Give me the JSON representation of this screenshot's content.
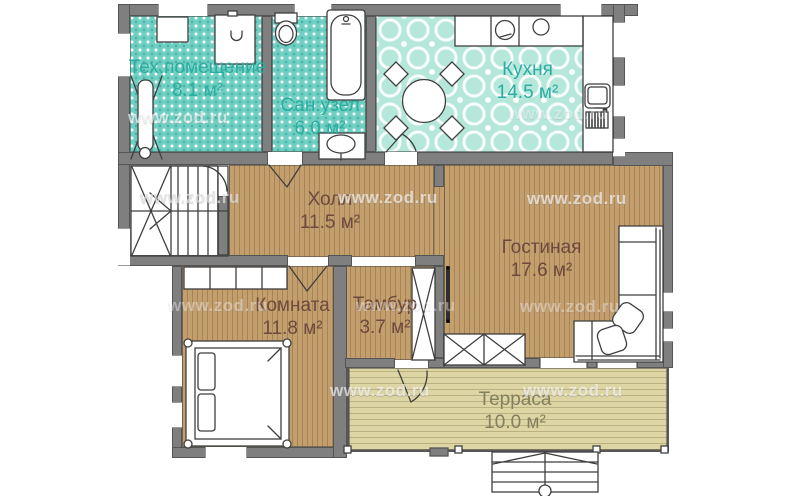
{
  "watermark": {
    "text": "www.zod.ru"
  },
  "rooms": [
    {
      "id": "tech",
      "name": "Тех.помещение",
      "area": "8.1 м²"
    },
    {
      "id": "san",
      "name": "Сан.узел",
      "area": "6.0 м²"
    },
    {
      "id": "kitchen",
      "name": "Кухня",
      "area": "14.5 м²"
    },
    {
      "id": "hall",
      "name": "Холл",
      "area": "11.5 м²"
    },
    {
      "id": "living",
      "name": "Гостиная",
      "area": "17.6 м²"
    },
    {
      "id": "bedroom",
      "name": "Комната",
      "area": "11.8 м²"
    },
    {
      "id": "tambour",
      "name": "Тамбур",
      "area": "3.7 м²"
    },
    {
      "id": "terrace",
      "name": "Терраса",
      "area": "10.0 м²"
    }
  ],
  "colors": {
    "wall": "#7f7f7f",
    "teal_room": "#6fcfc2",
    "kitchen_tile": "#b6e7db",
    "wood_floor": "#c49f6e",
    "terrace_floor": "#ded5a5",
    "teal_label": "#2bada2",
    "wood_label": "#6d4a3d",
    "terrace_label": "#838060"
  }
}
